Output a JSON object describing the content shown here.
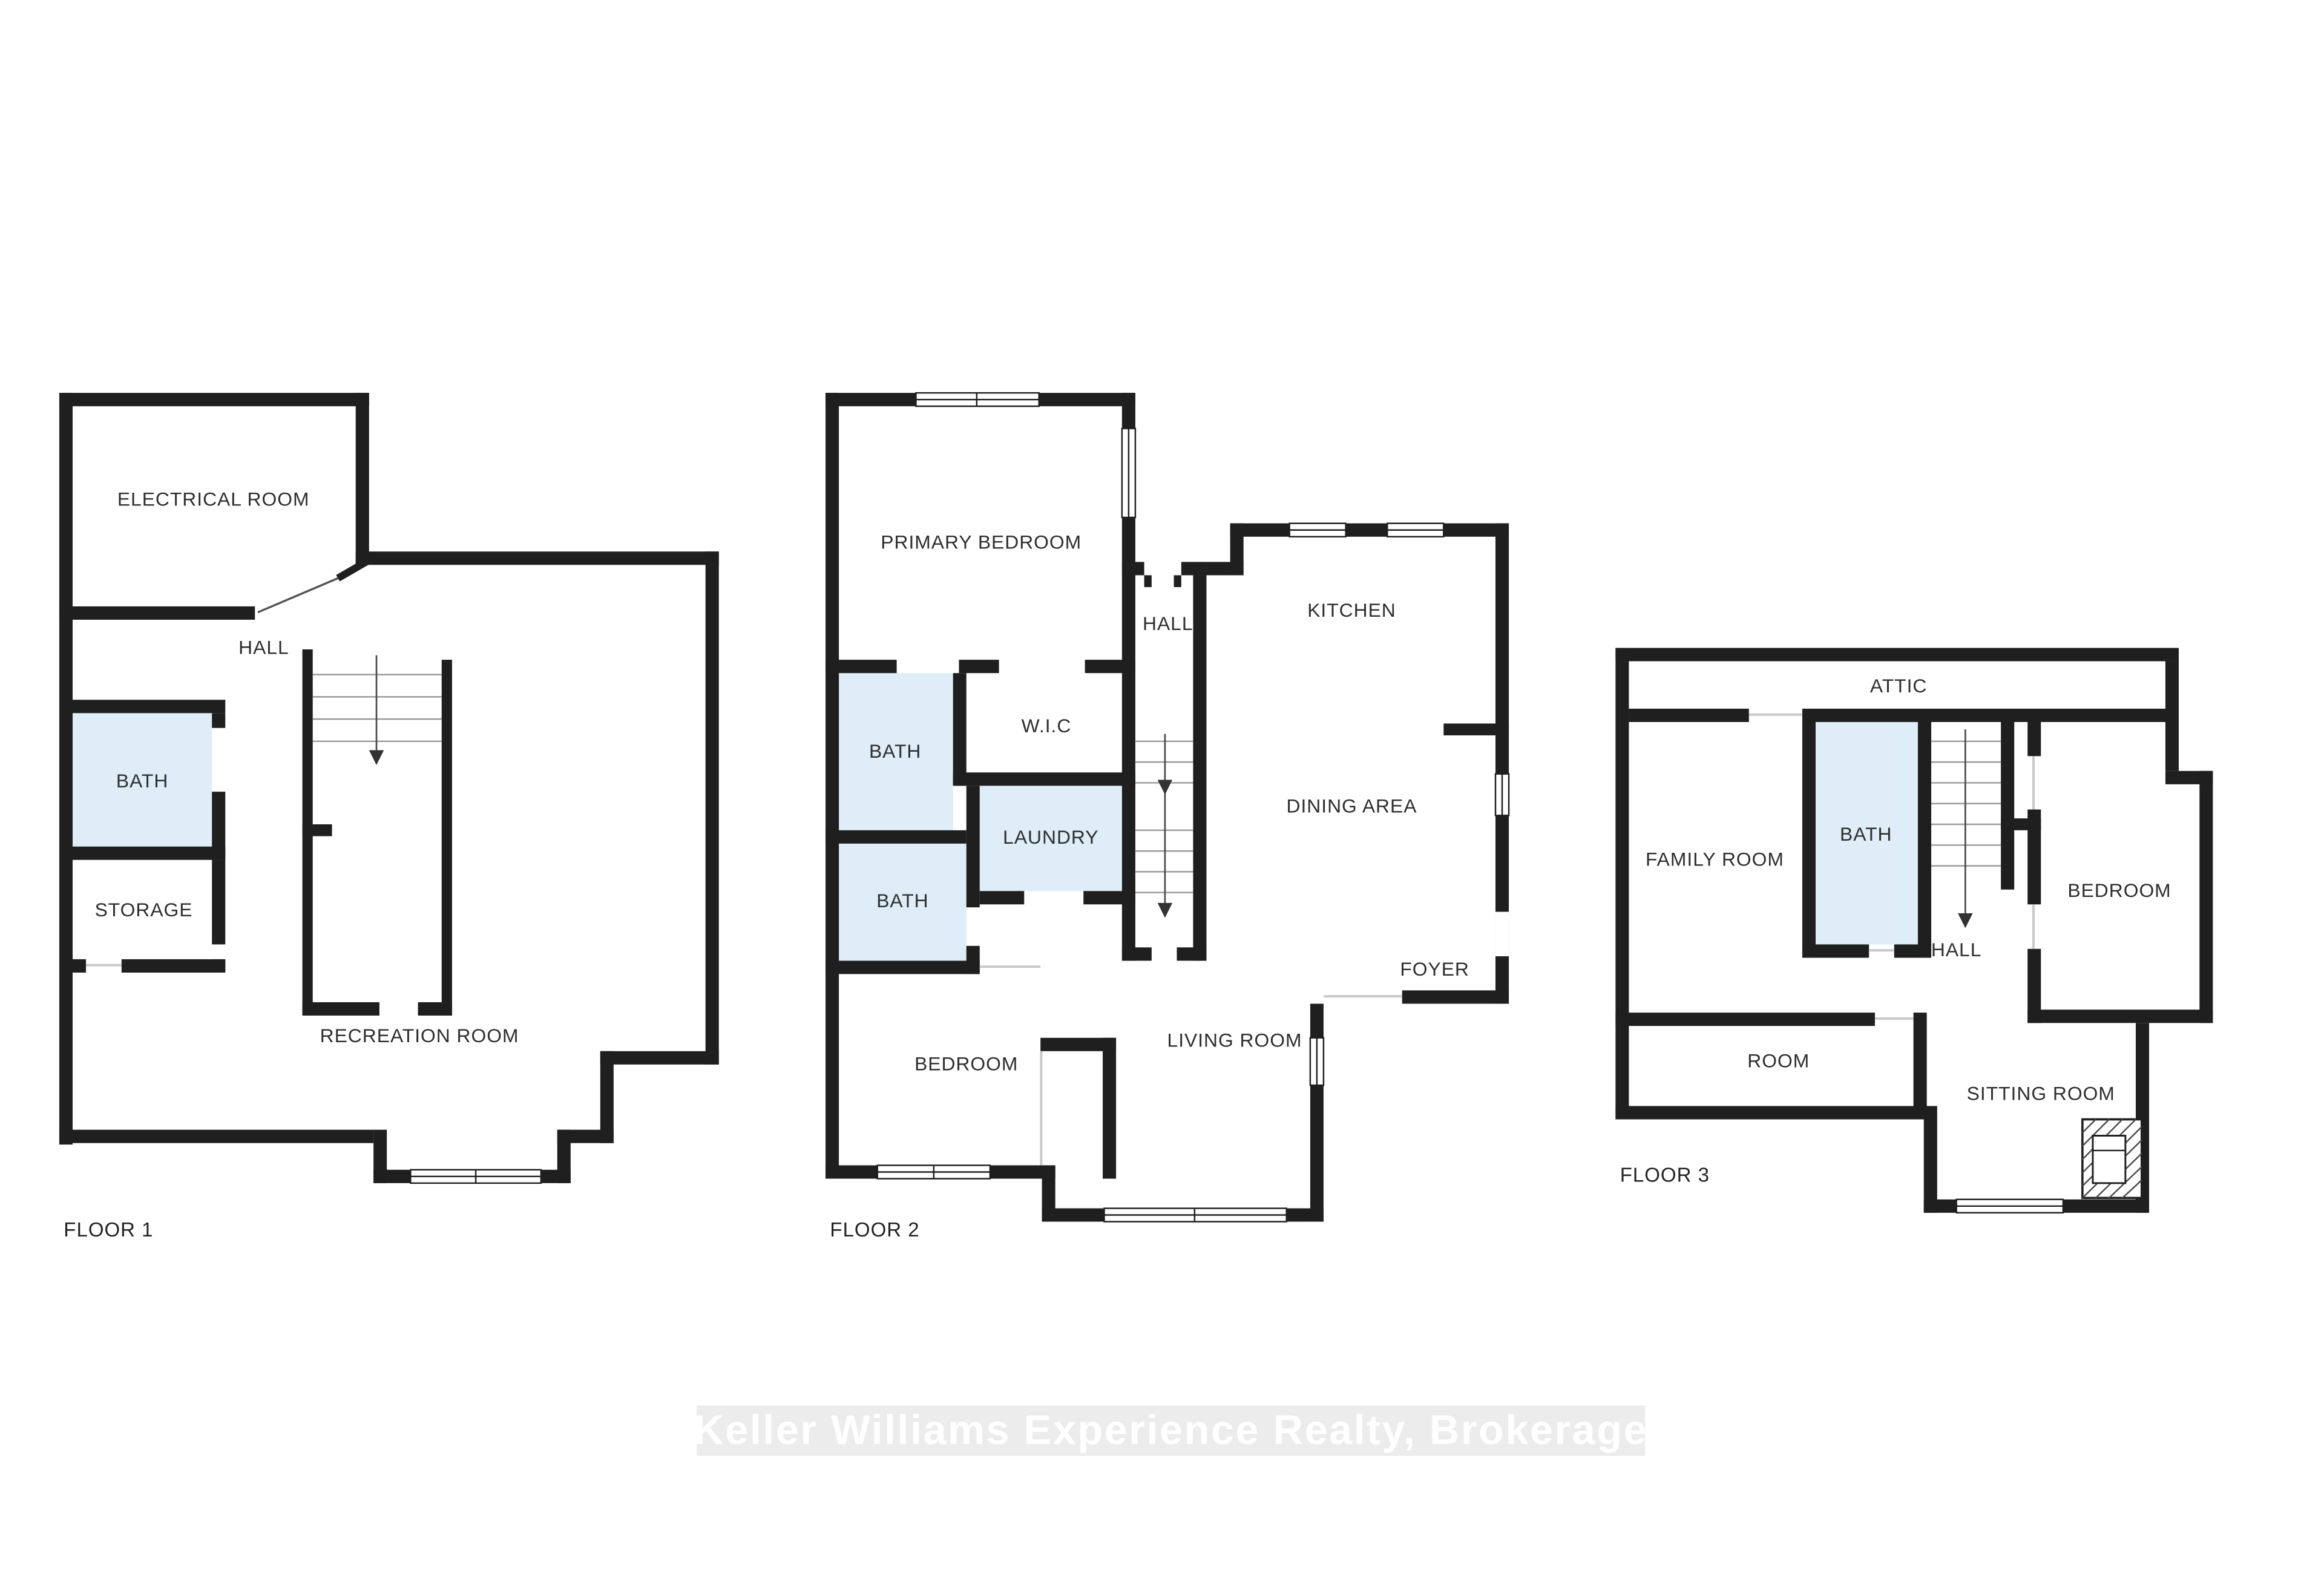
{
  "floors": [
    {
      "label": "FLOOR 1",
      "rooms": {
        "electrical": "ELECTRICAL ROOM",
        "hall": "HALL",
        "bath": "BATH",
        "storage": "STORAGE",
        "recreation": "RECREATION ROOM"
      }
    },
    {
      "label": "FLOOR 2",
      "rooms": {
        "primary": "PRIMARY BEDROOM",
        "hall": "HALL",
        "kitchen": "KITCHEN",
        "wic": "W.I.C",
        "bath_upper": "BATH",
        "laundry": "LAUNDRY",
        "bath_lower": "BATH",
        "dining": "DINING AREA",
        "foyer": "FOYER",
        "bedroom": "BEDROOM",
        "living": "LIVING ROOM"
      }
    },
    {
      "label": "FLOOR 3",
      "rooms": {
        "attic": "ATTIC",
        "family": "FAMILY ROOM",
        "bath": "BATH",
        "hall": "HALL",
        "bedroom": "BEDROOM",
        "room": "ROOM",
        "sitting": "SITTING ROOM"
      }
    }
  ],
  "watermark": {
    "text": "Keller Williams Experience Realty, Brokerage"
  },
  "colors": {
    "wall": "#1f1f1f",
    "bath_fill": "#deedf7",
    "watermark_bg": "#ececec",
    "watermark_text": "#ffffff"
  }
}
